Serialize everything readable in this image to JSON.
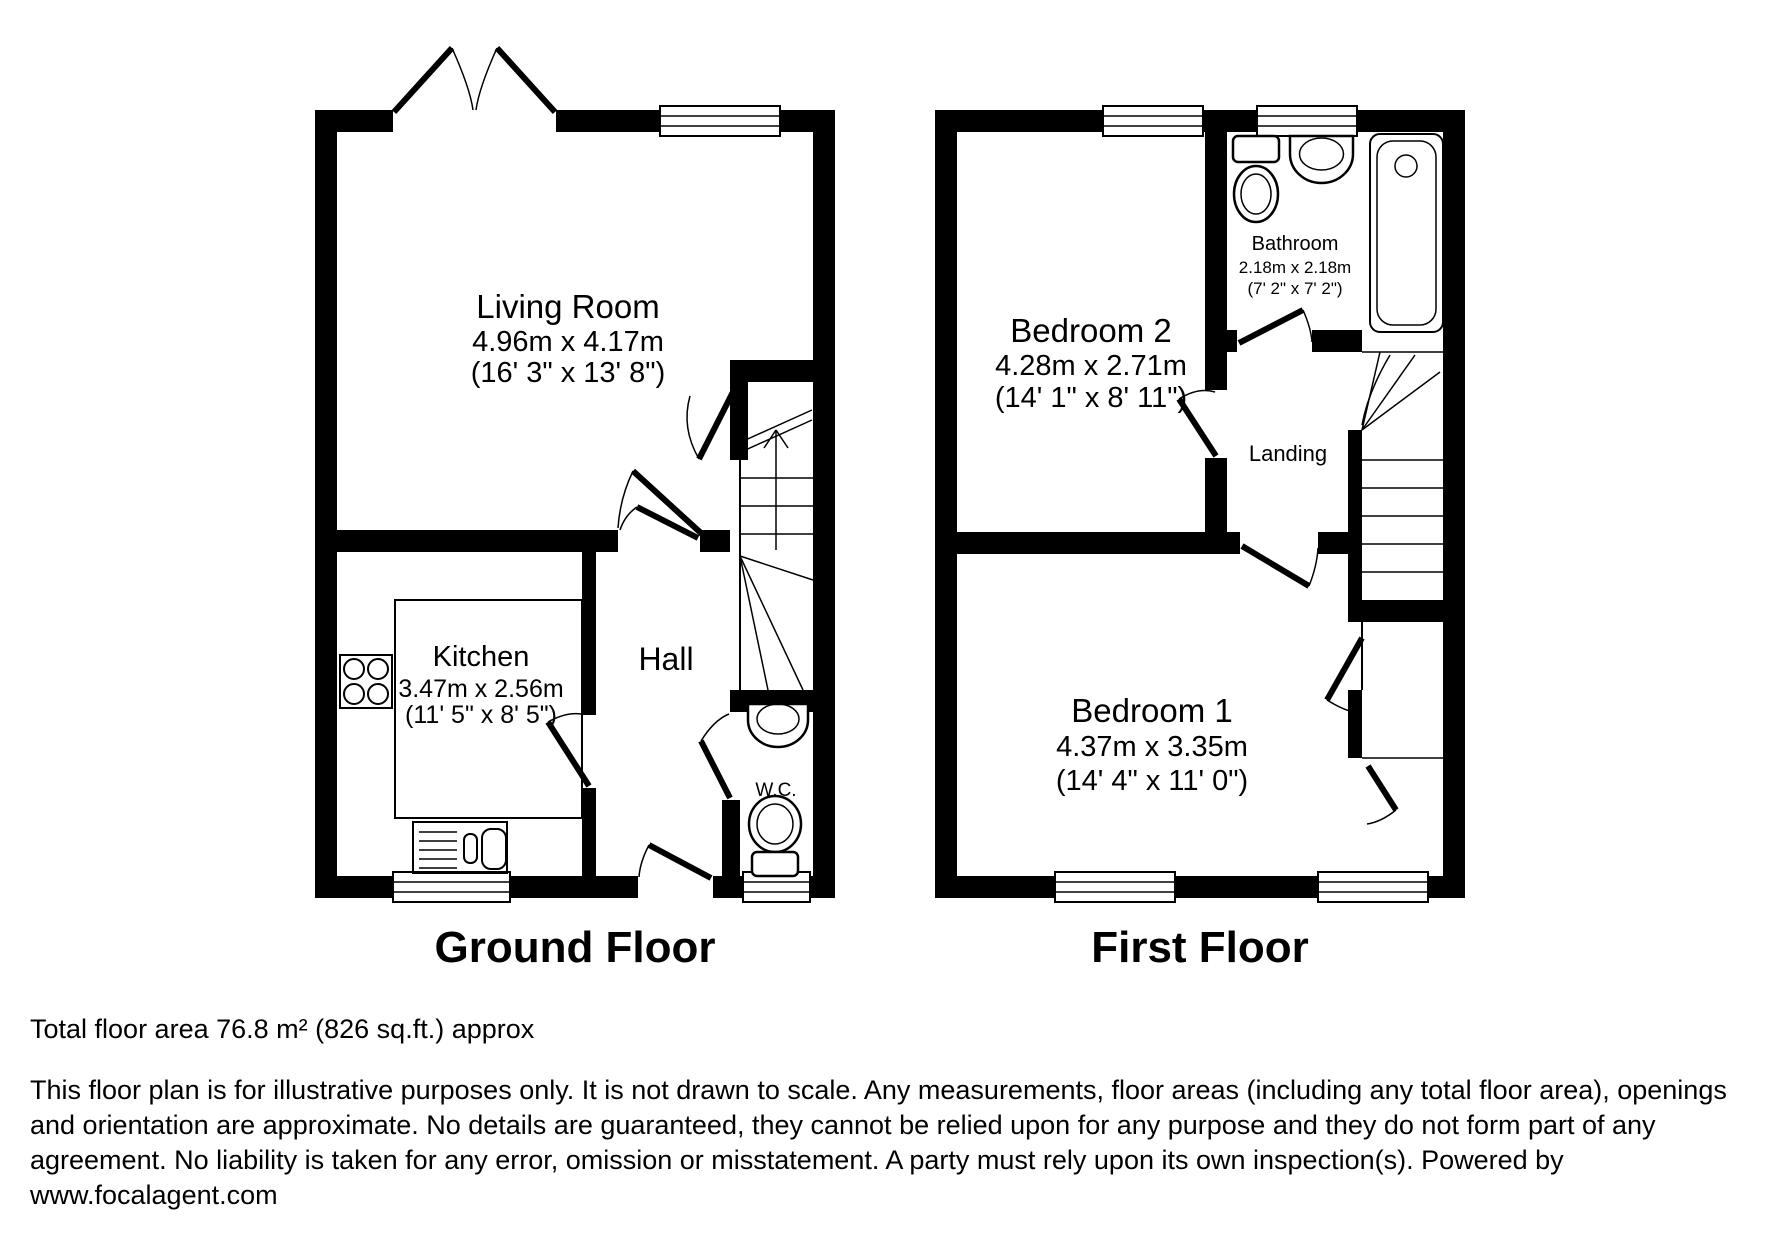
{
  "floors": {
    "ground": {
      "title": "Ground Floor"
    },
    "first": {
      "title": "First Floor"
    }
  },
  "rooms": {
    "living_room": {
      "name": "Living Room",
      "metric": "4.96m x 4.17m",
      "imperial": "(16' 3\" x 13' 8\")"
    },
    "kitchen": {
      "name": "Kitchen",
      "metric": "3.47m x 2.56m",
      "imperial": "(11' 5\" x 8' 5\")"
    },
    "hall": {
      "name": "Hall"
    },
    "wc": {
      "name": "W.C."
    },
    "bedroom2": {
      "name": "Bedroom 2",
      "metric": "4.28m x 2.71m",
      "imperial": "(14' 1\" x 8' 11\")"
    },
    "bathroom": {
      "name": "Bathroom",
      "metric": "2.18m x 2.18m",
      "imperial": "(7' 2\" x 7' 2\")"
    },
    "landing": {
      "name": "Landing"
    },
    "bedroom1": {
      "name": "Bedroom 1",
      "metric": "4.37m x 3.35m",
      "imperial": "(14' 4\" x 11' 0\")"
    }
  },
  "footer": {
    "total_area": "Total floor area 76.8 m² (826 sq.ft.) approx",
    "disclaimer": "This floor plan is for illustrative purposes only. It is not drawn to scale. Any measurements, floor areas (including any total floor area), openings and orientation are approximate. No details are guaranteed, they cannot be relied upon for any purpose and they do not form part of any agreement. No liability is taken for any error, omission or misstatement. A party must rely upon its own inspection(s). Powered by www.focalagent.com",
    "colors": {
      "wall": "#000000",
      "background": "#ffffff"
    }
  }
}
